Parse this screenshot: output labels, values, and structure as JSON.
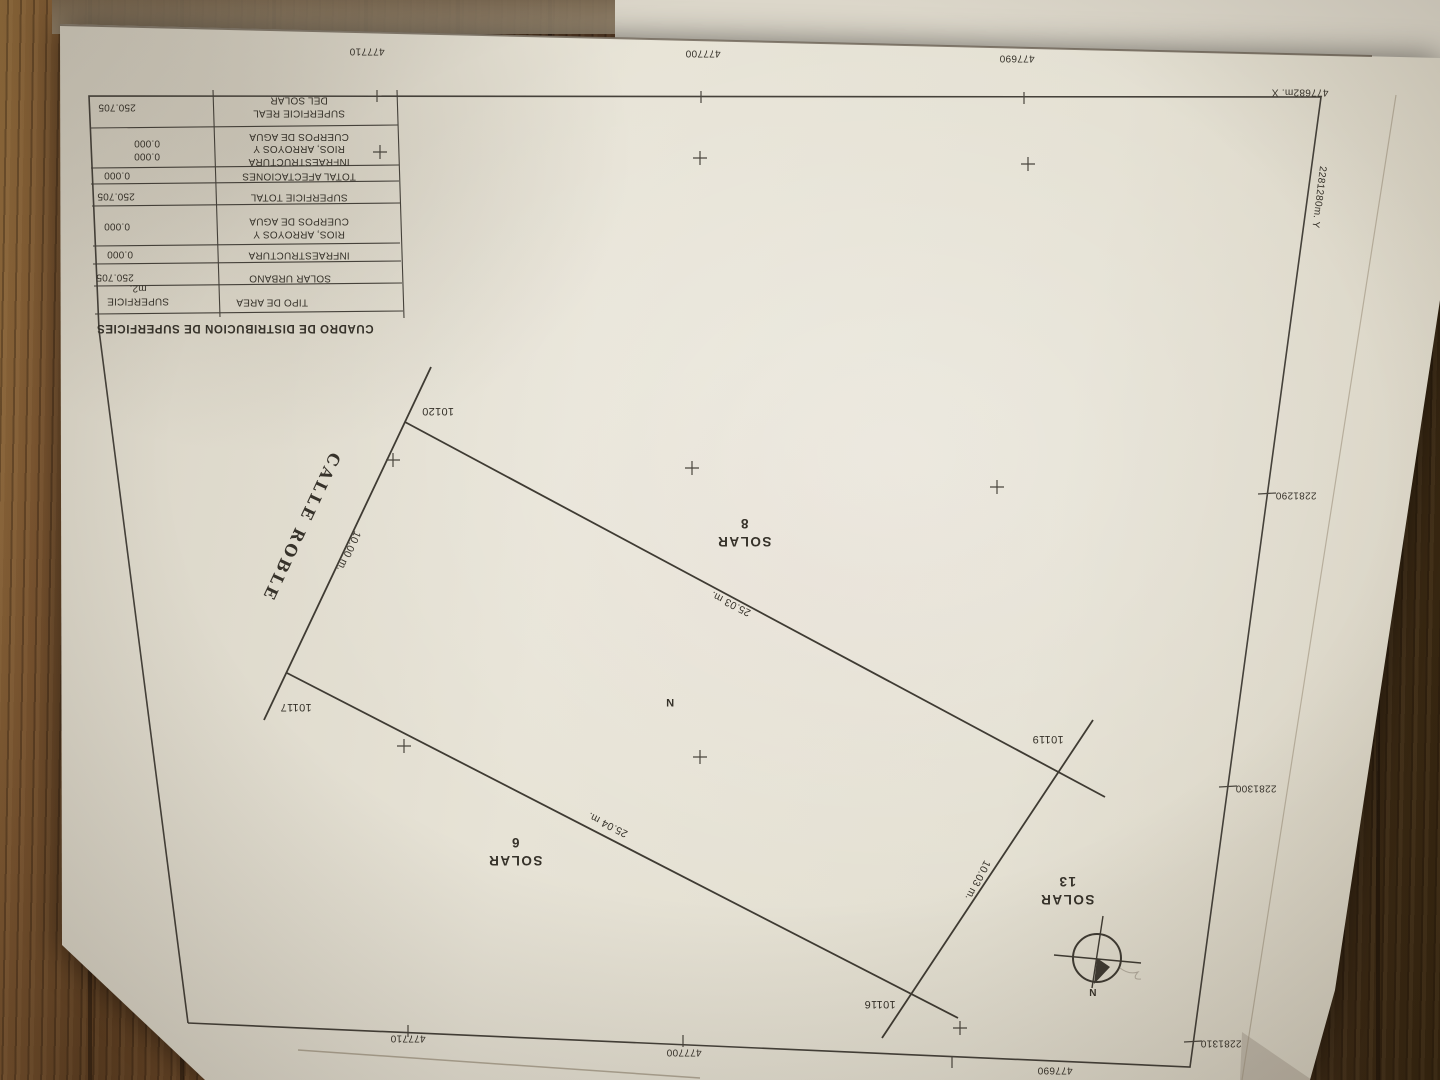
{
  "surface_table": {
    "title": "CUADRO DE DISTRIBUCION DE SUPERFICIES",
    "header": {
      "area_type": "TIPO DE AREA",
      "surface_line1": "SUPERFICIE",
      "surface_line2": "m2."
    },
    "rows": {
      "solar_urbano": {
        "label": "SOLAR URBANO",
        "value": "250.705"
      },
      "infraestructura": {
        "label": "INFRAESTRUCTURA",
        "value": "0.000"
      },
      "rios": {
        "label1": "RIOS, ARROYOS Y",
        "label2": "CUERPOS DE AGUA",
        "value": "0.000"
      },
      "superficie_total": {
        "label": "SUPERFICIE TOTAL",
        "value": "250.705"
      },
      "total_afectaciones": {
        "label": "TOTAL AFECTACIONES",
        "value": "0.000"
      },
      "afectaciones_detalle": {
        "label1": "INFRAESTRUCTURA",
        "label2": "RIOS, ARROYOS Y",
        "label3": "CUERPOS DE AGUA",
        "value1": "0.000",
        "value2": "0.000"
      },
      "superficie_real": {
        "label1": "SUPERFICIE REAL",
        "label2": "DEL SOLAR",
        "value": "250.705"
      }
    }
  },
  "map": {
    "street": "CALLE ROBLE",
    "parcels": {
      "top": {
        "name": "SOLAR",
        "number": "8"
      },
      "left": {
        "name": "SOLAR",
        "number": "6"
      },
      "right": {
        "name": "SOLAR",
        "number": "13"
      }
    },
    "center_mark": "N",
    "points": {
      "p10120": "10120",
      "p10117": "10117",
      "p10119": "10119",
      "p10116": "10116"
    },
    "measurements": {
      "front": "10.00 m.",
      "back": "10.03 m.",
      "side_a": "25.03 m.",
      "side_b": "25.04 m."
    },
    "compass_label": "N"
  },
  "grid": {
    "x_top": [
      "477710",
      "477700",
      "477690"
    ],
    "x_bottom": [
      "477710",
      "477700",
      "477690"
    ],
    "y_right": [
      "2281290",
      "2281300",
      "2281310"
    ],
    "corner_x_label": "477682m. X",
    "corner_y_label": "2281280m. Y"
  },
  "colors": {
    "ink": "#36322a",
    "paper": "#e3dfd1",
    "wood_dark": "#4e341e",
    "wood_light": "#8a6642"
  }
}
